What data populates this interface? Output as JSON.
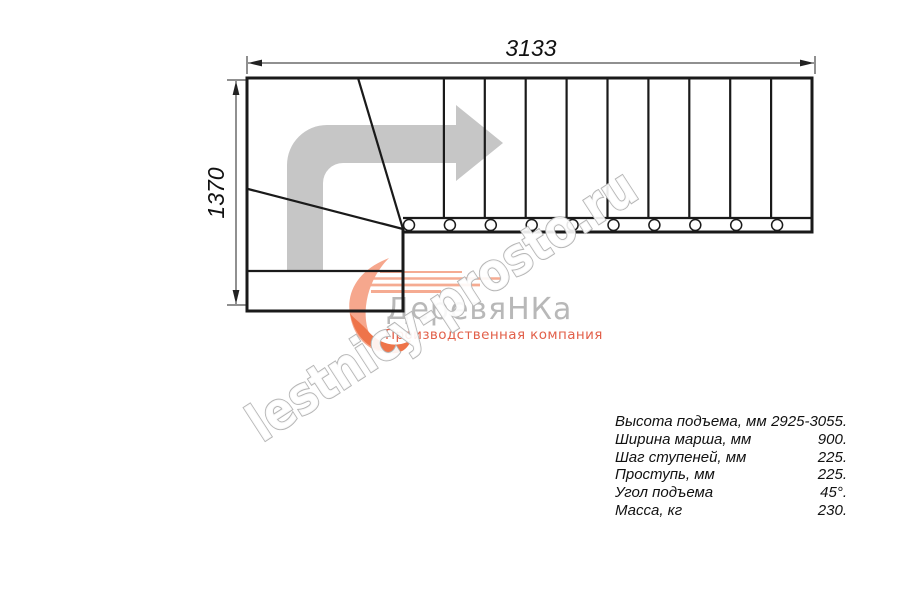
{
  "dimensions": {
    "width_label": "3133",
    "height_label": "1370"
  },
  "watermark": {
    "text": "lestnicy-prosto.ru"
  },
  "logo": {
    "name": "ДеревяНКа",
    "tagline": "Производственная компания"
  },
  "specs": {
    "rows": [
      {
        "label": "Высота подъема, мм",
        "value": "2925-3055."
      },
      {
        "label": "Ширина марша, мм",
        "value": "900."
      },
      {
        "label": "Шаг ступеней, мм",
        "value": "225."
      },
      {
        "label": "Проступь, мм",
        "value": "225."
      },
      {
        "label": "Угол подъема",
        "value": "45°."
      },
      {
        "label": "Масса, кг",
        "value": "230."
      }
    ]
  },
  "plan": {
    "straight_treads": 10,
    "balusters": 10,
    "winder_treads": 3,
    "turn": "quarter-turn left-to-right, direction of climb shown by arrow"
  },
  "colors": {
    "line_black": "#1a1a1a",
    "arrow_gray": "#c6c6c6",
    "watermark_outline": "#b5b5b5",
    "logo_gray": "#b8b8b8",
    "logo_orange_light": "#f6a78d",
    "logo_orange_dark": "#ee744a",
    "tagline_red": "#e2604a"
  }
}
